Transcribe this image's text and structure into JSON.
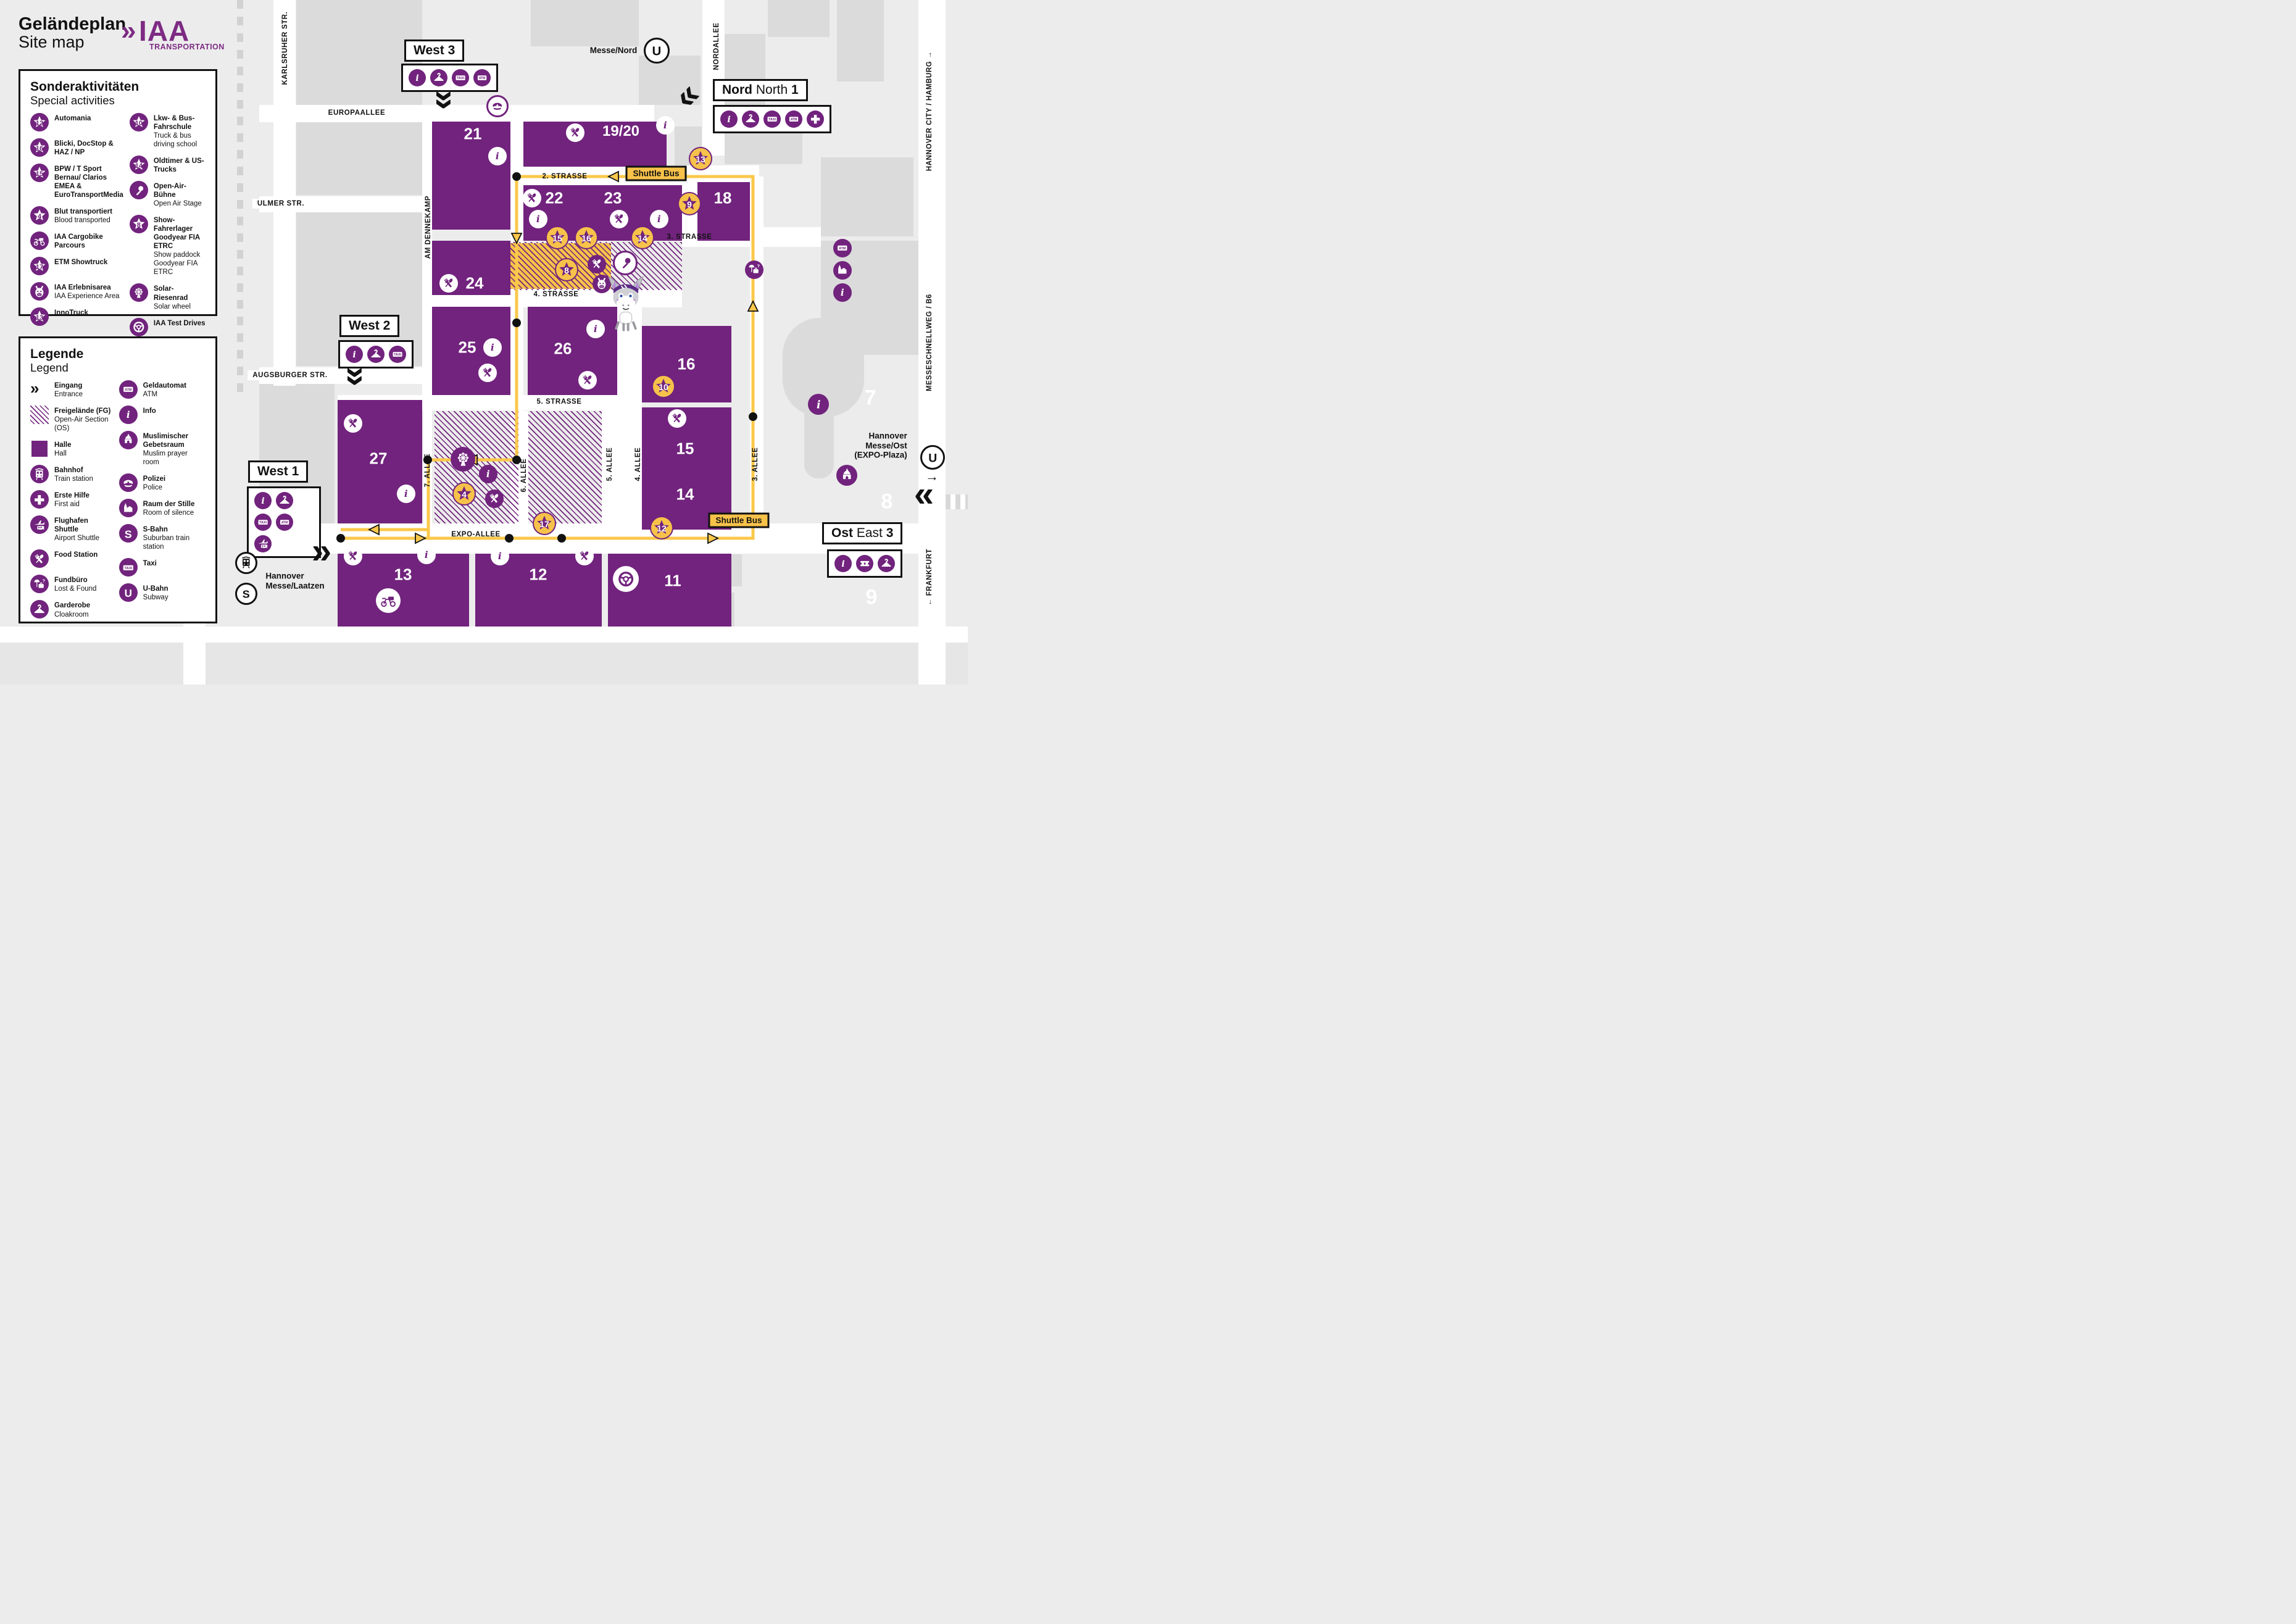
{
  "colors": {
    "purple": "#71237D",
    "star_yellow": "#F7C24A",
    "route_yellow": "#FBC84B",
    "background": "#ECECEC",
    "street_white": "#FFFFFF",
    "building_gray": "#DBDBDB",
    "ink": "#111111"
  },
  "header": {
    "title_de": "Geländeplan",
    "title_en": "Site map",
    "logo_chevrons": "»",
    "logo_brand": "IAA",
    "logo_sub": "TRANSPORTATION"
  },
  "special_activities": {
    "title_de": "Sonderaktivitäten",
    "title_en": "Special activities",
    "items": [
      {
        "badge": "12",
        "icon": "star",
        "label_de": "Automania",
        "label_en": ""
      },
      {
        "badge": "16",
        "icon": "star",
        "label_de": "Blicki, DocStop & HAZ / NP",
        "label_en": ""
      },
      {
        "badge": "15",
        "icon": "star",
        "label_de": "BPW / T Sport Bernau/ Clarios EMEA & EuroTransportMedia",
        "label_en": ""
      },
      {
        "badge": "4",
        "icon": "star",
        "label_de": "Blut transportiert",
        "label_en": "Blood transported"
      },
      {
        "badge": "",
        "icon": "cargobike",
        "label_de": "IAA Cargobike Parcours",
        "label_en": ""
      },
      {
        "badge": "17",
        "icon": "star",
        "label_de": "ETM Showtruck",
        "label_en": ""
      },
      {
        "badge": "",
        "icon": "mascotface",
        "label_de": "IAA Erlebnisarea",
        "label_en": "IAA Experience Area"
      },
      {
        "badge": "13",
        "icon": "star",
        "label_de": "InnoTruck",
        "label_en": ""
      },
      {
        "badge": "10",
        "icon": "star",
        "label_de": "Lkw- & Bus-Fahrschule",
        "label_en": "Truck & bus driving school"
      },
      {
        "badge": "14",
        "icon": "star",
        "label_de": "Oldtimer & US-Trucks",
        "label_en": ""
      },
      {
        "badge": "",
        "icon": "mic",
        "label_de": "Open-Air-Bühne",
        "label_en": "Open Air Stage"
      },
      {
        "badge": "8",
        "icon": "star",
        "label_de": "Show-Fahrerlager Goodyear FIA ETRC",
        "label_en": "Show paddock Goodyear FIA ETRC"
      },
      {
        "badge": "",
        "icon": "ferris",
        "label_de": "Solar-Riesenrad",
        "label_en": "Solar wheel"
      },
      {
        "badge": "",
        "icon": "steering",
        "label_de": "IAA Test Drives",
        "label_en": ""
      },
      {
        "badge": "9",
        "icon": "star",
        "label_de": "Unimog Experience",
        "label_en": ""
      }
    ]
  },
  "legend": {
    "title_de": "Legende",
    "title_en": "Legend",
    "items": [
      {
        "icon": "entrance",
        "de": "Eingang",
        "en": "Entrance"
      },
      {
        "icon": "openair",
        "de": "Freigelände (FG)",
        "en": "Open-Air Section (OS)"
      },
      {
        "icon": "hall",
        "de": "Halle",
        "en": "Hall"
      },
      {
        "icon": "train",
        "de": "Bahnhof",
        "en": "Train station"
      },
      {
        "icon": "firstaid",
        "de": "Erste Hilfe",
        "en": "First aid"
      },
      {
        "icon": "airport",
        "de": "Flughafen Shuttle",
        "en": "Airport Shuttle"
      },
      {
        "icon": "food",
        "de": "Food Station",
        "en": ""
      },
      {
        "icon": "lostfound",
        "de": "Fundbüro",
        "en": "Lost & Found"
      },
      {
        "icon": "cloakroom",
        "de": "Garderobe",
        "en": "Cloakroom"
      },
      {
        "icon": "atm",
        "de": "Geldautomat",
        "en": "ATM"
      },
      {
        "icon": "info",
        "de": "Info",
        "en": ""
      },
      {
        "icon": "mosque",
        "de": "Muslimischer Gebetsraum",
        "en": "Muslim prayer room"
      },
      {
        "icon": "police",
        "de": "Polizei",
        "en": "Police"
      },
      {
        "icon": "church",
        "de": "Raum der Stille",
        "en": "Room of silence"
      },
      {
        "icon": "sbahn",
        "de": "S-Bahn",
        "en": "Suburban train station"
      },
      {
        "icon": "taxi",
        "de": "Taxi",
        "en": ""
      },
      {
        "icon": "ubahn",
        "de": "U-Bahn",
        "en": "Subway"
      }
    ]
  },
  "map": {
    "shuttle_label": "Shuttle Bus",
    "halls": [
      {
        "id": "21",
        "amenities": [
          "info"
        ]
      },
      {
        "id": "19/20",
        "amenities": [
          "food",
          "info"
        ]
      },
      {
        "id": "22",
        "amenities": [
          "food",
          "info"
        ]
      },
      {
        "id": "23",
        "amenities": [
          "food",
          "info"
        ]
      },
      {
        "id": "18",
        "amenities": []
      },
      {
        "id": "24",
        "amenities": [
          "food"
        ]
      },
      {
        "id": "25",
        "amenities": [
          "info",
          "food"
        ]
      },
      {
        "id": "26",
        "amenities": [
          "info",
          "food"
        ]
      },
      {
        "id": "16",
        "amenities": []
      },
      {
        "id": "15",
        "amenities": [
          "food"
        ]
      },
      {
        "id": "14",
        "amenities": []
      },
      {
        "id": "27",
        "amenities": [
          "food",
          "info"
        ]
      },
      {
        "id": "13",
        "amenities": [
          "food",
          "info",
          "cargobike"
        ]
      },
      {
        "id": "12",
        "amenities": [
          "info",
          "food"
        ]
      },
      {
        "id": "11",
        "amenities": [
          "steering"
        ]
      }
    ],
    "gray_halls": [
      "7",
      "8",
      "9"
    ],
    "stars": [
      "13",
      "9",
      "15",
      "16",
      "14",
      "8",
      "10",
      "4",
      "17",
      "12"
    ],
    "streets": {
      "karlsruher": "KARLSRUHER STR.",
      "europaallee": "EUROPAALLEE",
      "nordallee": "NORDALLEE",
      "ulmer": "ULMER STR.",
      "dennekamp": "AM DENNEKAMP",
      "augsburger": "AUGSBURGER STR.",
      "s2": "2. STRASSE",
      "s3": "3. STRASSE",
      "s4": "4. STRASSE",
      "s5": "5. STRASSE",
      "expo": "EXPO-ALLEE",
      "a7": "7. ALLEE",
      "a6": "6. ALLEE",
      "a5": "5. ALLEE",
      "a4": "4. ALLEE",
      "a3": "3. ALLEE",
      "schnellweg": "MESSESCHNELLWEG / B6",
      "hamburg": "HANNOVER CITY / HAMBURG  →",
      "frankfurt": "←  FRANKFURT"
    },
    "entrances": [
      {
        "id": "west3",
        "de": "West",
        "en": "",
        "num": "3",
        "icons": [
          "info",
          "cloakroom",
          "taxi",
          "atm"
        ]
      },
      {
        "id": "nord1",
        "de": "Nord",
        "en": "North",
        "num": "1",
        "icons": [
          "info",
          "cloakroom",
          "taxi",
          "atm",
          "firstaid"
        ]
      },
      {
        "id": "west2",
        "de": "West",
        "en": "",
        "num": "2",
        "icons": [
          "info",
          "cloakroom",
          "taxi"
        ]
      },
      {
        "id": "west1",
        "de": "West",
        "en": "",
        "num": "1",
        "icons": [
          "info",
          "cloakroom",
          "taxi",
          "atm",
          "airport"
        ]
      },
      {
        "id": "ost3",
        "de": "Ost",
        "en": "East",
        "num": "3",
        "icons": [
          "info",
          "ticket",
          "cloakroom"
        ]
      }
    ],
    "stations": [
      {
        "id": "messe_nord",
        "label": "Messe/Nord"
      },
      {
        "id": "laatzen",
        "label": "Hannover\nMesse/Laatzen"
      },
      {
        "id": "expo_plaza",
        "label": "Hannover\nMesse/Ost\n(EXPO-Plaza)"
      }
    ],
    "poi": [
      {
        "id": "police_west3",
        "icon": "police"
      },
      {
        "id": "mic_stage",
        "icon": "mic"
      },
      {
        "id": "mascot_face",
        "icon": "mascotface"
      },
      {
        "id": "ferris_oa",
        "icon": "ferris"
      },
      {
        "id": "info_oa",
        "icon": "info"
      },
      {
        "id": "food_oa",
        "icon": "food"
      },
      {
        "id": "food_stage",
        "icon": "food"
      },
      {
        "id": "lostfound_r",
        "icon": "lostfound"
      },
      {
        "id": "atm_r",
        "icon": "atm"
      },
      {
        "id": "church_r",
        "icon": "church"
      },
      {
        "id": "info_r1",
        "icon": "info"
      },
      {
        "id": "info_r2",
        "icon": "info"
      },
      {
        "id": "mosque_r",
        "icon": "mosque"
      }
    ]
  }
}
